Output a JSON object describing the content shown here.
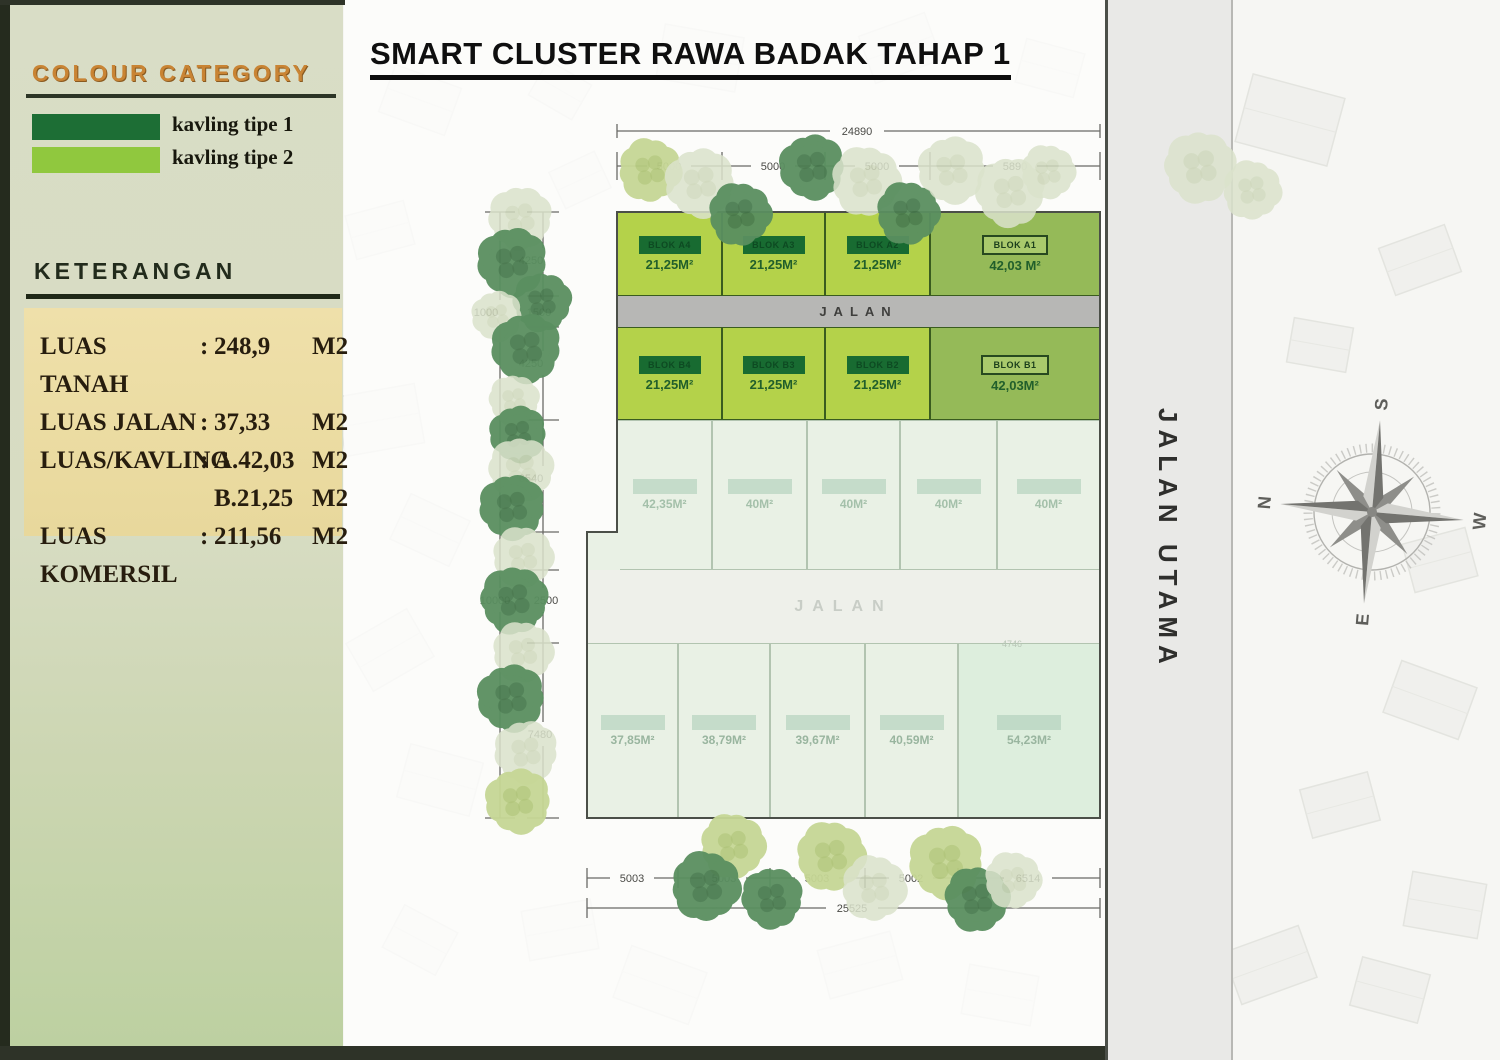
{
  "legend": {
    "title": "COLOUR CATEGORY",
    "items": [
      {
        "label": "kavling tipe 1",
        "color": "#1d6e35"
      },
      {
        "label": "kavling tipe 2",
        "color": "#90c83e"
      }
    ],
    "keterangan_title": "KETERANGAN",
    "stats": [
      {
        "label": "LUAS TANAH",
        "sep": ":",
        "value": "248,9",
        "unit": "M2"
      },
      {
        "label": "LUAS JALAN",
        "sep": ":",
        "value": "37,33",
        "unit": "M2"
      },
      {
        "label": "LUAS/KAVLING",
        "sep": ":",
        "value": "A.42,03",
        "unit": "M2"
      },
      {
        "label": "",
        "sep": "",
        "value": "B.21,25",
        "unit": "M2"
      },
      {
        "label": "LUAS KOMERSIL",
        "sep": ":",
        "value": "211,56",
        "unit": "M2"
      }
    ]
  },
  "title": "SMART CLUSTER RAWA BADAK TAHAP 1",
  "plan": {
    "road1": "JALAN",
    "road2": "JALAN",
    "main_road": "JALAN UTAMA",
    "rowA": [
      {
        "label": "BLOK A4",
        "area": "21,25M²"
      },
      {
        "label": "BLOK A3",
        "area": "21,25M²"
      },
      {
        "label": "BLOK A2",
        "area": "21,25M²"
      },
      {
        "label": "BLOK A1",
        "area": "42,03 M²"
      }
    ],
    "rowB": [
      {
        "label": "BLOK B4",
        "area": "21,25M²"
      },
      {
        "label": "BLOK B3",
        "area": "21,25M²"
      },
      {
        "label": "BLOK B2",
        "area": "21,25M²"
      },
      {
        "label": "BLOK B1",
        "area": "42,03M²"
      }
    ],
    "rowC": [
      {
        "area": "42,35M²"
      },
      {
        "area": "40M²"
      },
      {
        "area": "40M²"
      },
      {
        "area": "40M²"
      },
      {
        "area": "40M²"
      }
    ],
    "rowD": [
      {
        "area": "37,85M²"
      },
      {
        "area": "38,79M²"
      },
      {
        "area": "39,67M²"
      },
      {
        "area": "40,59M²"
      },
      {
        "area": "54,23M²"
      }
    ]
  },
  "dimensions": {
    "top_total": "24890",
    "top_segments": [
      "5000",
      "5000",
      "5000",
      "5890"
    ],
    "left": [
      "4250",
      "1000",
      "1500",
      "4250",
      "6540",
      "10000",
      "2500",
      "7480"
    ],
    "bottom_segments": [
      "5003",
      "5003",
      "5003",
      "5002",
      "6514"
    ],
    "bottom_total": "25525",
    "row_d_top": "4746"
  },
  "compass": {
    "n": "N",
    "e": "E",
    "s": "S",
    "w": "W"
  },
  "colors": {
    "kavling_tipe_1": "#1d6e35",
    "kavling_tipe_2": "#90c83e",
    "accent_orange": "#c98434",
    "stats_bg": "#ecdca2"
  }
}
